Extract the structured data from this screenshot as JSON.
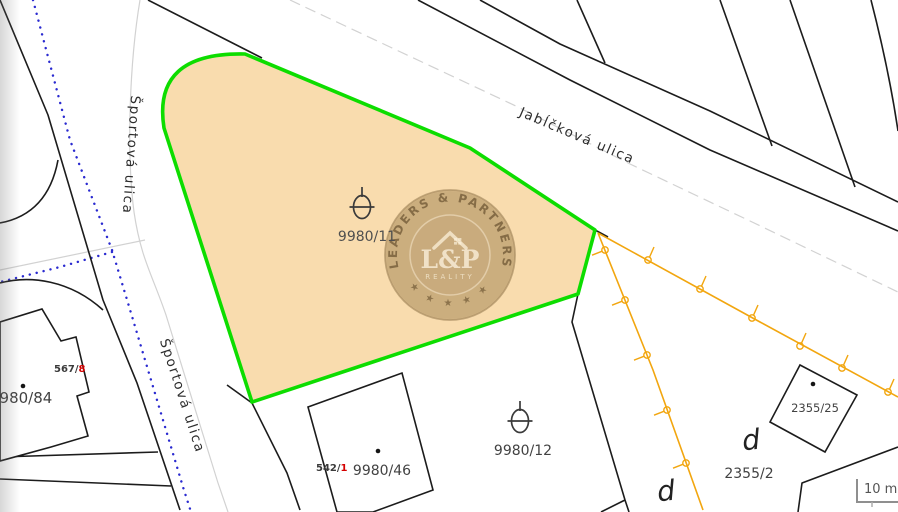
{
  "colors": {
    "highlight_fill": "#f9dcae",
    "highlight_border": "#0ddd00",
    "boundary_black": "#1c1c1c",
    "fence_orange": "#f2a60f",
    "utility_blue": "#2a2ad0",
    "centerline_gray": "#d2d2d2",
    "label_red": "#d40000"
  },
  "streets": {
    "sportova_upper": "Športová ulica",
    "sportova_lower": "Športová ulica",
    "jablckova": "Jabĺčková ulica"
  },
  "parcels": {
    "highlighted": "9980/11",
    "p9980_12": "9980/12",
    "p9980_46": "9980/46",
    "p9980_84": "9980/84",
    "p2355_25": "2355/25",
    "p2355_2": "2355/2",
    "p567_8_prefix": "567/",
    "p567_8_suffix": "8",
    "p542_1_prefix": "542/",
    "p542_1_suffix": "1",
    "d_marker_1": "d",
    "d_marker_2": "d"
  },
  "watermark": {
    "arc_text": "LEADERS & PARTNERS",
    "monogram": "L&P",
    "subtitle": "REALITY",
    "stars": "★ ★ ★ ★ ★"
  },
  "scale_bar": {
    "label": "10 m"
  }
}
